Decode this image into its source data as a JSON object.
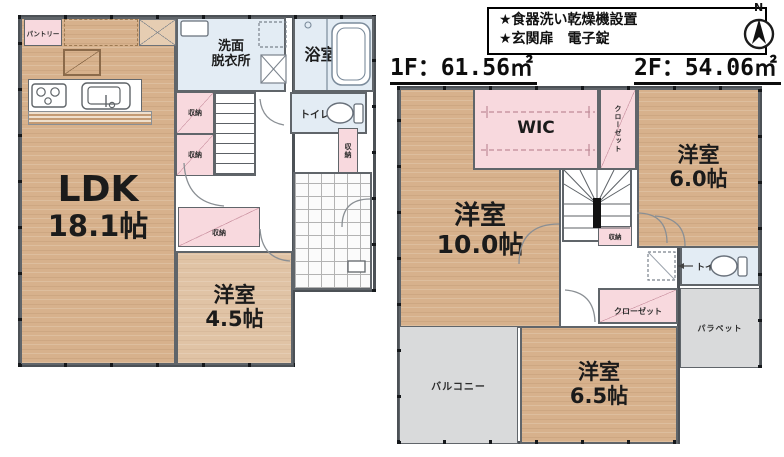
{
  "header": {
    "features": [
      "★食器洗い乾燥機設置",
      "★玄関扉　電子錠"
    ],
    "area_1f": "1F：61.56㎡",
    "area_2f": "2F：54.06㎡",
    "compass_n": "N"
  },
  "colors": {
    "wood": "#d7b18c",
    "wood_light": "#e0c3a5",
    "closet_pink": "#f8d9de",
    "wet_blue": "#e3ecf4",
    "outdoor_gray": "#d9dadb",
    "wall": "#4c5156"
  },
  "floor1": {
    "ldk_name": "LDK",
    "ldk_size": "18.1帖",
    "pantry": "パントリー",
    "washroom": "洗面\n脱衣所",
    "bath": "浴室",
    "toilet": "トイレ",
    "storage_a": "収納",
    "storage_b": "収納",
    "storage_c": "収納",
    "storage_d": "収納",
    "room45_name": "洋室",
    "room45_size": "4.5帖"
  },
  "floor2": {
    "room10_name": "洋室",
    "room10_size": "10.0帖",
    "room60_name": "洋室",
    "room60_size": "6.0帖",
    "room65_name": "洋室",
    "room65_size": "6.5帖",
    "wic": "WIC",
    "closet_v": "クローゼット",
    "closet_h": "クローゼット",
    "storage": "収納",
    "toilet": "トイレ",
    "balcony": "バルコニー",
    "parapet": "パラペット"
  }
}
